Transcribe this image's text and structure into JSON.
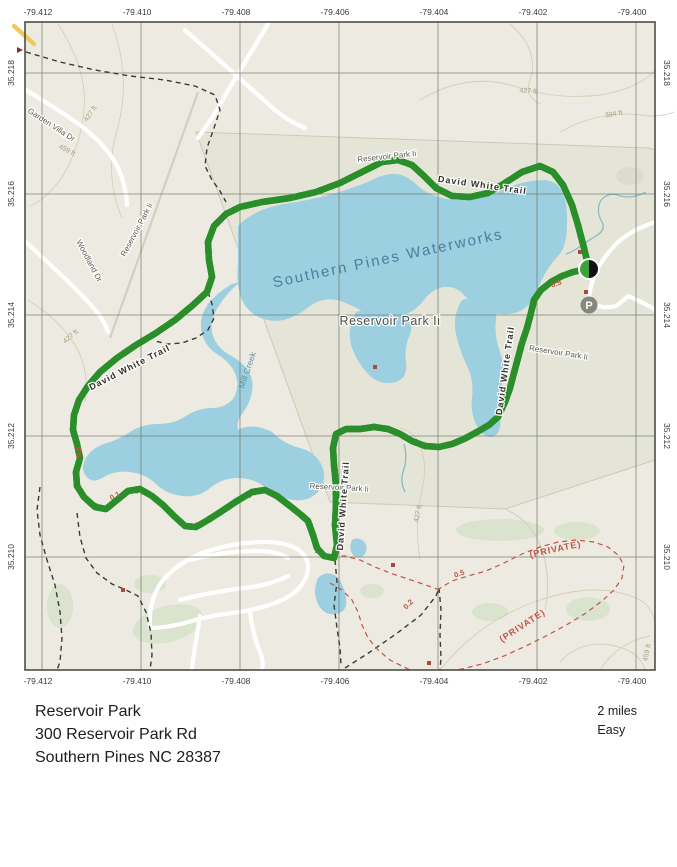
{
  "map": {
    "axes": {
      "lon": [
        "-79.412",
        "-79.410",
        "-79.408",
        "-79.406",
        "-79.404",
        "-79.402",
        "-79.400"
      ],
      "lat": [
        "35.218",
        "35.216",
        "35.214",
        "35.212",
        "35.210"
      ]
    },
    "place_labels": {
      "waterworks": "Southern Pines Waterworks",
      "park": "Reservoir Park Ii",
      "mill_creek": "Mill Creek",
      "trail": "David White Trail",
      "garden_villa_dr": "Garden Villa Dr",
      "woodland_dr": "Woodland Dr",
      "private": "(PRIVATE)",
      "parking_symbol": "P"
    },
    "contour_labels": {
      "c394": "394 ft",
      "c427": "427 ft",
      "c459": "459 ft"
    },
    "distance_labels": {
      "d01": "0.1",
      "d02": "0.2",
      "d05": "0.5"
    },
    "colors": {
      "water": "#9ccfdf",
      "route_green": "#52cc52",
      "land": "#edebe1",
      "private_red": "#c0544a"
    }
  },
  "footer": {
    "park_name": "Reservoir Park",
    "address_line": "300 Reservoir Park Rd",
    "city_line": "Southern Pines NC 28387",
    "distance": "2 miles",
    "difficulty": "Easy"
  }
}
